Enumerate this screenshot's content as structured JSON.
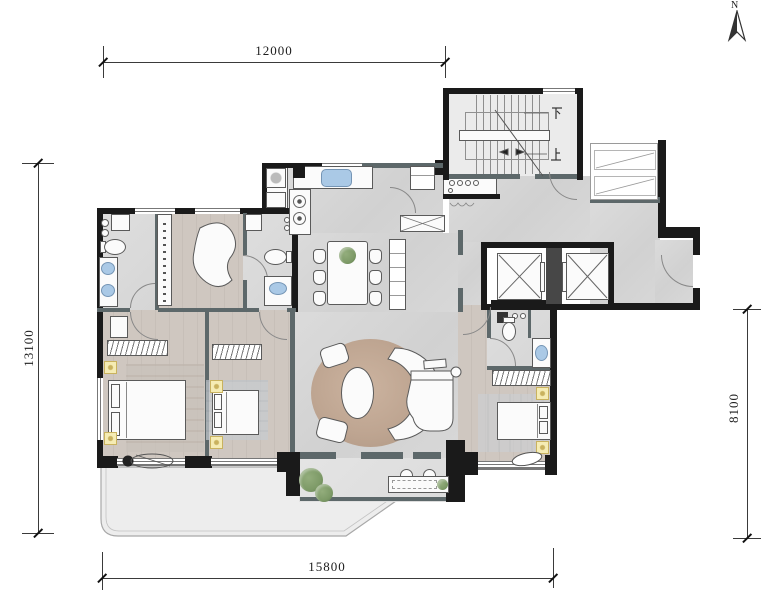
{
  "type": "architectural-floor-plan",
  "compass": {
    "north_label": "N"
  },
  "dimensions": {
    "top": "12000",
    "left": "13100",
    "right": "8100",
    "bottom": "15800"
  },
  "stairwell": {
    "down_label": "下",
    "up_label": "上"
  },
  "colors": {
    "wall": "#1a1a1a",
    "pwall": "#5d686a",
    "marble": "#d6d6d6",
    "wood": "#cfc7c0",
    "stair": "#ebebeb",
    "terrace": "#ededed",
    "rug": "#bca08a",
    "water": "#aac9e6",
    "light": "#f5ecb4",
    "plant": "#7d9a67"
  },
  "icons": {
    "north-arrow-icon": "half-filled compass needle",
    "stairs-icon": "treads with landing and direction arrow",
    "elevator-icon": "shaft box with X cross",
    "double-bed-icon": "rectangle with pillows",
    "sofa-icon": "curved crescent seat",
    "piano-icon": "grand piano outline",
    "dining-table-icon": "table with six chairs",
    "desk-icon": "kidney-shaped desk",
    "toilet-icon": "oval bowl with tank",
    "sink-icon": "blue oval basin",
    "kitchen-sink-icon": "blue rectangle basin",
    "stove-icon": "two burner circles",
    "washer-icon": "square with drum circle",
    "wardrobe-icon": "hatched strip",
    "ceiling-light-icon": "yellow square with bulb",
    "plant-icon": "green foliage circle",
    "chaise-icon": "lounge chair outline"
  }
}
